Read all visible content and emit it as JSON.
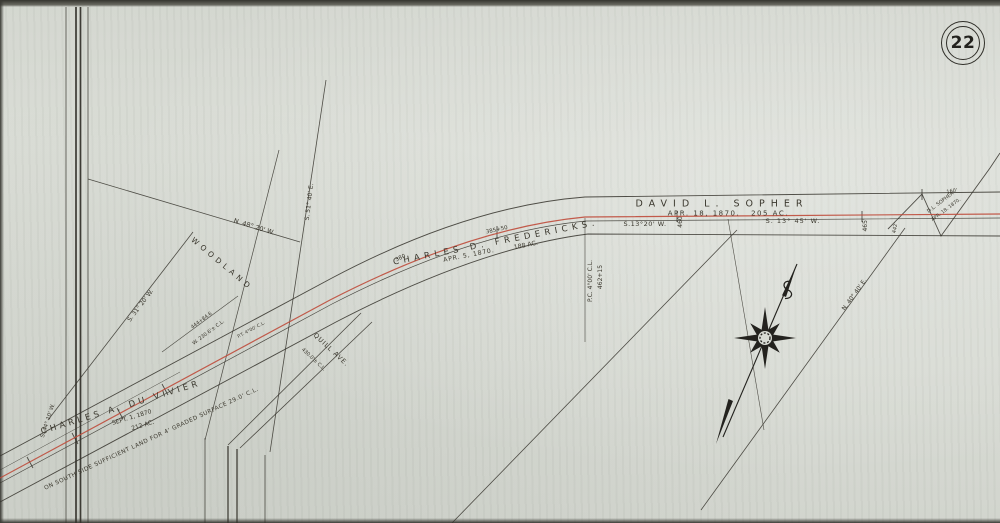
{
  "page": {
    "badge": "22"
  },
  "colors": {
    "paper": "#d8dbd4",
    "ink": "#35332c",
    "red_line": "#bf4b3b"
  },
  "parcels": {
    "sopher": {
      "owner": "DAVID  L.  SOPHER",
      "date": "APR. 18, 1870.",
      "acres": "205 AC."
    },
    "fredericks": {
      "owner": "CHARLES   D.   FREDERICKS.",
      "date": "APR. 5, 1870.",
      "acres": "188 AC."
    },
    "duvivier": {
      "owner": "CHARLES  A. DU VIVIER",
      "date": "SEPT. 1, 1870",
      "acres": "212 AC."
    },
    "sopher_small": {
      "owner": "D.L. SOPHER",
      "date": "APR. 18. 1870."
    }
  },
  "bearings": {
    "s13_20": "S.13°20' W.",
    "s13_45": "S. 13° 45' W.",
    "n48_20": "N. 48° 20' W.",
    "s51_40": "S. 51° 40' E.",
    "s31_20": "S. 31° 20' W.",
    "n40_40": "N. 40° 40' E.",
    "s44_10": "S. 44° 10' W."
  },
  "stations": {
    "sta_380": "380",
    "sta_385_50": "385+50",
    "sta_460": "460",
    "sta_465": "465'",
    "sta_442": "442'",
    "sta_160": "160'",
    "pc": "P.C. 4°00' C.L.",
    "pc_sta": "462+15",
    "pt": "P.T. 4°00' C.L.",
    "tie_sta": "444+84.6",
    "tie_offset": "W. 230.6'± C.L."
  },
  "features": {
    "woodland": "WOODLAND",
    "avenue": "QUILL  AVE.",
    "avenue_offset": "430.0'± C.L."
  },
  "notes": {
    "south_side": "ON SOUTH SIDE SUFFICIENT LAND FOR 4' GRADED SURFACE 29.0' C.L."
  }
}
